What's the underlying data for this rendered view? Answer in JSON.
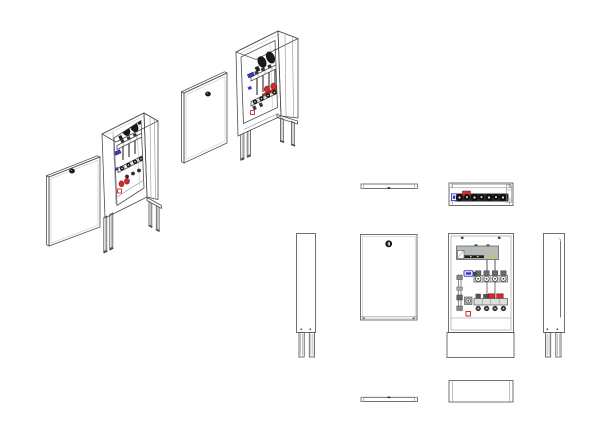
{
  "sheet": {
    "background": "#ffffff",
    "kind": "manifold-cabinet-drawing",
    "views": {
      "isometric": [
        {
          "id": "door-panel-upper",
          "knob": true
        },
        {
          "id": "cabinet-open-upper",
          "manifold_visible": true
        },
        {
          "id": "door-panel-lower",
          "knob": true
        },
        {
          "id": "cabinet-open-lower",
          "manifold_visible": true
        }
      ],
      "orthographic": [
        {
          "id": "door-top"
        },
        {
          "id": "cabinet-top"
        },
        {
          "id": "cabinet-side-left"
        },
        {
          "id": "door-front"
        },
        {
          "id": "cabinet-front"
        },
        {
          "id": "cabinet-side-right"
        },
        {
          "id": "door-bottom"
        },
        {
          "id": "cabinet-bottom"
        }
      ]
    },
    "components": {
      "manifold": {
        "circuit_count": 4,
        "flow_meter_circles_top_row": 4,
        "return_knobs_bottom_row": 4,
        "red_caps_front_view": 2,
        "supply_valve": "blue-handle",
        "wiring_box": "gray-with-dark-terminal-strip"
      },
      "door": {
        "lock_knob": true
      },
      "legs_per_view": 2
    }
  },
  "colors": {
    "line": "#4e4e4e",
    "line_light": "#b8bcb8",
    "panel_face": "#eceeec",
    "panel_side": "#d6dad6",
    "panel_top": "#f5f7f5",
    "frame_face": "#e9ebe9",
    "interior": "#ffffff",
    "metal_dark": "#1a1a1a",
    "metal_mid": "#555555",
    "rail_silver": "#b2b8b8",
    "box_gray": "#b8bcb8",
    "supply_blue": "#3a3ac8",
    "return_red": "#d22b2b",
    "terminal_yellow": "#d2c53c"
  }
}
